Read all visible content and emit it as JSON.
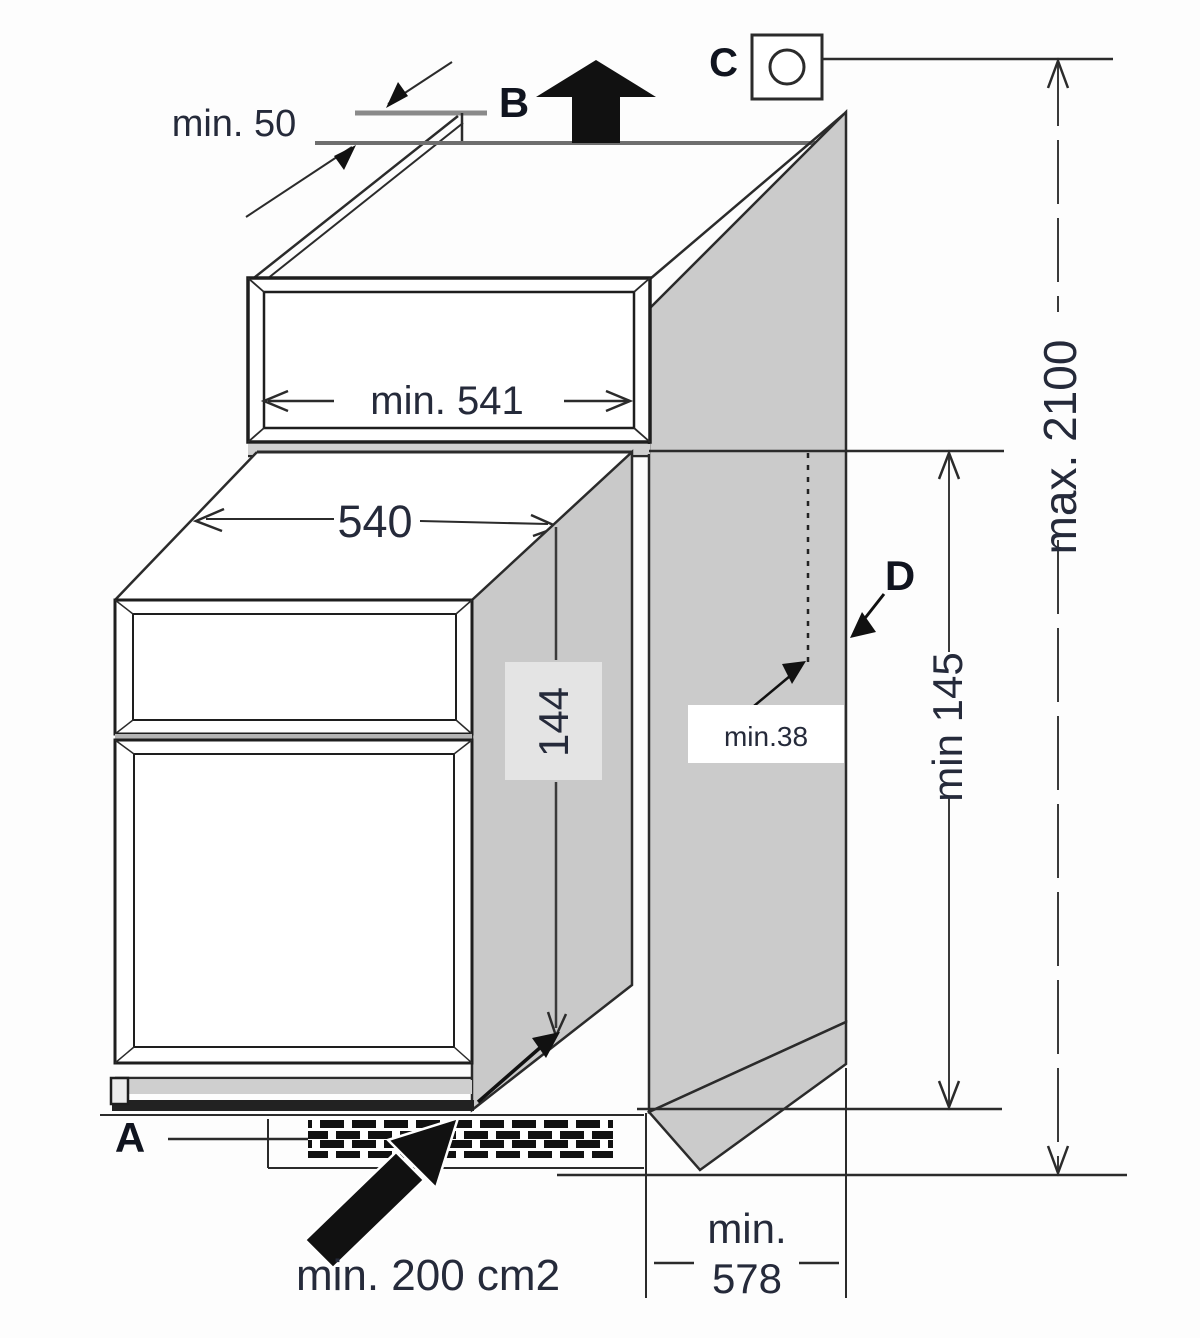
{
  "figure": {
    "kind": "appliance-built-in-installation-diagram",
    "description": "Isometric line drawing of a built-in refrigerator housing column with ventilation and niche dimensions"
  },
  "callouts": {
    "a": "A",
    "b": "B",
    "c": "C",
    "d": "D"
  },
  "dims": {
    "top_gap": "min. 50",
    "niche_width": "min. 541",
    "appliance_width": "540",
    "recess_height": "144",
    "panel_clearance": "min.38",
    "bottom_clearance": "min 145",
    "total_height": "max. 2100",
    "depth_min": "min.",
    "depth_value": "578",
    "vent_area": "min. 200 cm2"
  },
  "icons": [
    {
      "name": "socket-icon",
      "meaning": "electrical outlet symbol (square with circle)"
    },
    {
      "name": "air-out-arrow-icon",
      "meaning": "solid black arrow pointing up (air outlet B)"
    },
    {
      "name": "air-in-arrow-icon",
      "meaning": "solid black arrow pointing up-right into vent grille (air inlet A)"
    },
    {
      "name": "vent-grille",
      "meaning": "hatched ventilation strip in plinth"
    }
  ],
  "colors": {
    "background": "#fdfdfd",
    "panel_gray": "#cbcbcb",
    "band_gray": "#d0d0d0",
    "label_box_gray": "#e4e4e4",
    "line_dark": "#262626",
    "line_gray": "#8a8a8a",
    "text_dark": "#232838",
    "arrow_black": "#111111"
  }
}
